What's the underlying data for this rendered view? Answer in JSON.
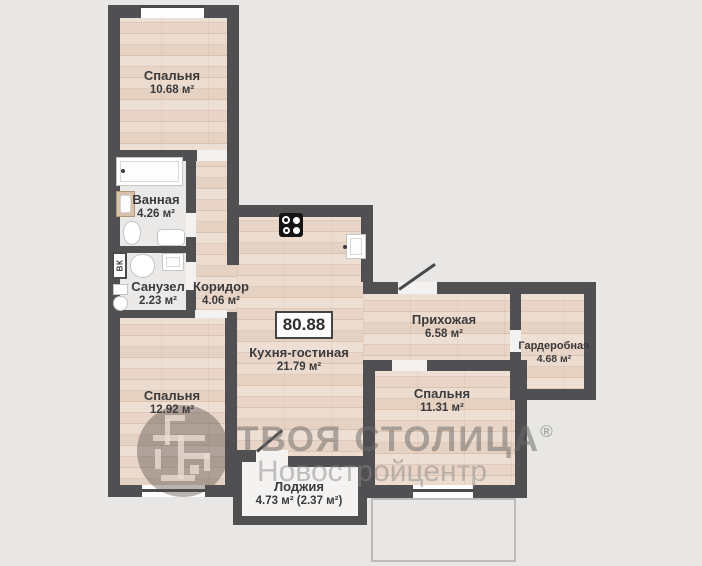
{
  "plan": {
    "total_area": "80.88",
    "shaft_label": "ВК",
    "rooms": [
      {
        "name": "Спальня",
        "area": "10.68 м²"
      },
      {
        "name": "Ванная",
        "area": "4.26 м²"
      },
      {
        "name": "Санузел",
        "area": "2.23 м²"
      },
      {
        "name": "Коридор",
        "area": "4.06 м²"
      },
      {
        "name": "Кухня-гостиная",
        "area": "21.79 м²"
      },
      {
        "name": "Прихожая",
        "area": "6.58 м²"
      },
      {
        "name": "Гардеробная",
        "area": "4.68 м²"
      },
      {
        "name": "Спальня",
        "area": "12.92 м²"
      },
      {
        "name": "Спальня",
        "area": "11.31 м²"
      },
      {
        "name": "Лоджия",
        "area": "4.73 м² (2.37 м²)"
      }
    ],
    "watermark": {
      "brand": "ТВОЯ СТОЛИЦА",
      "registered": "®",
      "subtitle": "Новостройцентр"
    },
    "colors": {
      "background": "#e8e7e5",
      "wall": "#504f51",
      "wood_floor": "#e9d7c9",
      "tile_floor": "#eae9e7",
      "loggia_floor": "#f4f3f2",
      "label_text": "#3b3a3c",
      "watermark_gray": "#8b8987"
    }
  }
}
